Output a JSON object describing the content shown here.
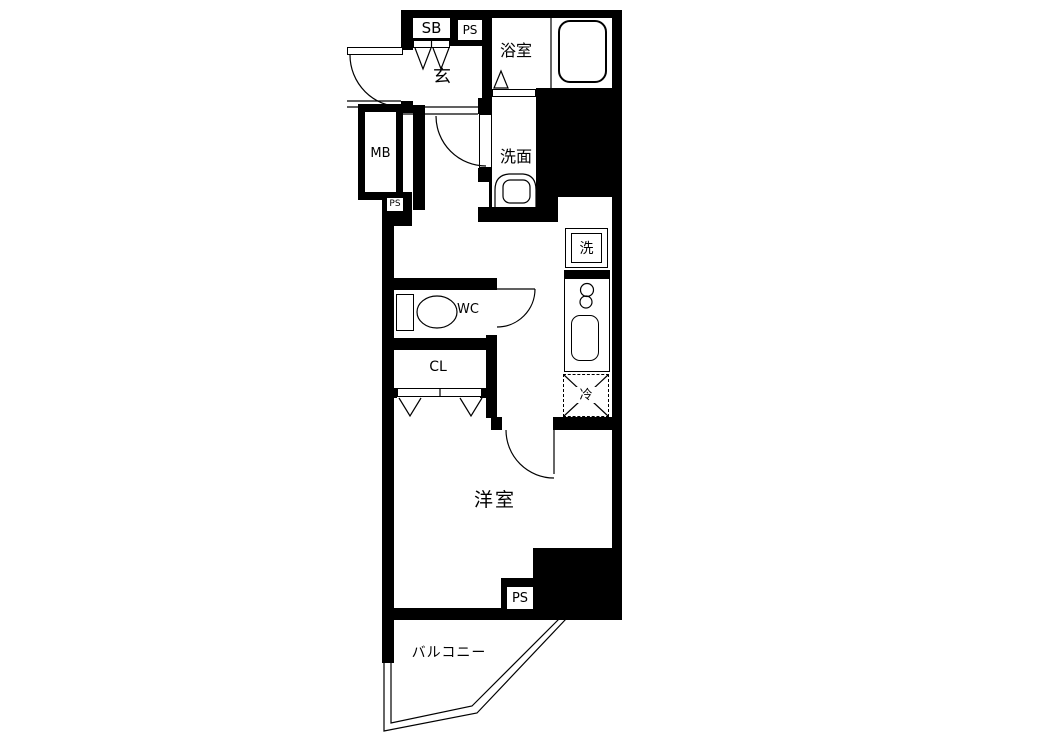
{
  "colors": {
    "wall": "#000000",
    "background": "#ffffff",
    "line": "#000000"
  },
  "rooms": {
    "genkan": {
      "label": "玄"
    },
    "bathroom": {
      "label": "浴室"
    },
    "washroom": {
      "label": "洗面"
    },
    "toilet_room": {
      "label": "WC"
    },
    "closet": {
      "label": "CL"
    },
    "western_room": {
      "label": "洋室"
    },
    "balcony": {
      "label": "バルコニー"
    }
  },
  "fixtures": {
    "shoe_box": {
      "label": "SB"
    },
    "pipe_space_top": {
      "label": "PS"
    },
    "meter_box": {
      "label": "MB"
    },
    "pipe_space_middle": {
      "label": "PS"
    },
    "washing_machine": {
      "label": "洗"
    },
    "refrigerator": {
      "label": "冷"
    },
    "pipe_space_bottom": {
      "label": "PS"
    }
  }
}
